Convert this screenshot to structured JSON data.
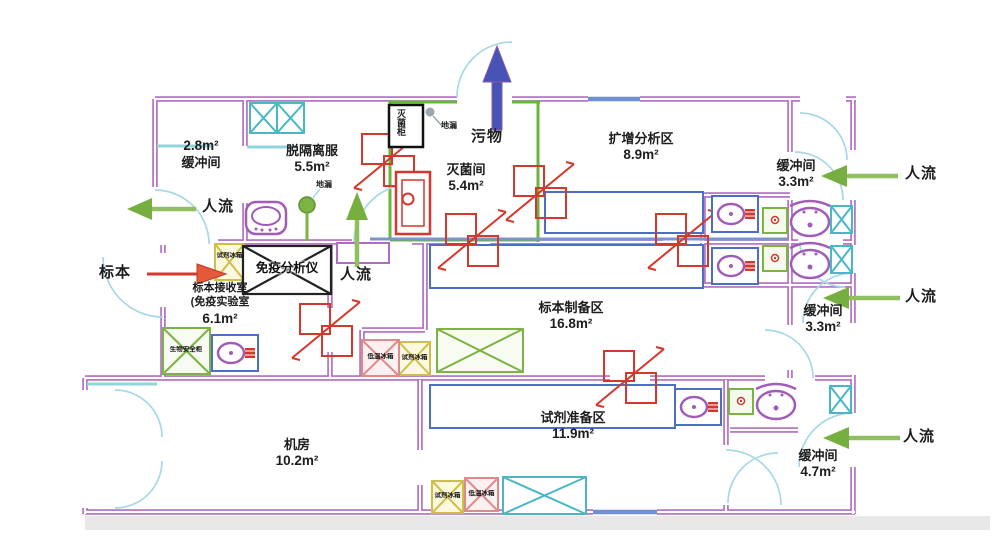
{
  "plan_title": "PCR实验室平面布局图",
  "rooms": [
    {
      "name": "缓冲间",
      "area": "2.8m²"
    },
    {
      "name": "脱隔离服",
      "area": "5.5m²"
    },
    {
      "name": "灭菌间",
      "area": "5.4m²"
    },
    {
      "name": "扩增分析区",
      "area": "8.9m²"
    },
    {
      "name": "缓冲间",
      "area": "3.3m²"
    },
    {
      "name": "缓冲间",
      "area": "3.3m²"
    },
    {
      "name": "标本接收室",
      "name2": "(免疫实验室",
      "area": "6.1m²"
    },
    {
      "name": "标本制备区",
      "area": "16.8m²"
    },
    {
      "name": "机房",
      "area": "10.2m²"
    },
    {
      "name": "试剂准备区",
      "area": "11.9m²"
    },
    {
      "name": "缓冲间",
      "area": "4.7m²"
    }
  ],
  "flows": {
    "people": [
      {
        "label": "人流",
        "direction": "left-out",
        "location": "top-left-buffer"
      },
      {
        "label": "人流",
        "direction": "up",
        "location": "center-corridor"
      },
      {
        "label": "人流",
        "direction": "left-in",
        "location": "top-right-buffer"
      },
      {
        "label": "人流",
        "direction": "left-in",
        "location": "mid-right-buffer"
      },
      {
        "label": "人流",
        "direction": "left-in",
        "location": "bottom-right-buffer"
      }
    ],
    "specimen": {
      "label": "标本",
      "direction": "right-in"
    },
    "waste": {
      "label": "污物",
      "direction": "up-out"
    }
  },
  "equipment": {
    "immuno_analyzer": {
      "label": "免疫分析仪"
    },
    "sterilizer": {
      "label": "灭菌柜"
    },
    "floor_drains": [
      {
        "label": "地漏"
      },
      {
        "label": "地漏"
      }
    ],
    "reagent_fridges": [
      {
        "label": "试剂冰箱"
      },
      {
        "label": "试剂冰箱"
      },
      {
        "label": "试剂冰箱"
      }
    ],
    "freezers": [
      {
        "label": "低温冰箱"
      },
      {
        "label": "低温冰箱"
      }
    ],
    "biosafety_cabinet": {
      "label": "生物安全柜"
    }
  },
  "colors": {
    "wall": "#b06cbf",
    "sterile_room_wall": "#6cb33f",
    "pass_through_red": "#d4372b",
    "flow_arrow_green": "#76ae3f",
    "waste_arrow_blue": "#4753b5",
    "specimen_arrow_red": "#d4372b",
    "door_arc": "#a8d8e6",
    "bench_blue": "#4a6fc4",
    "fixture_purple": "#a15cb8",
    "cabinet_cyan": "#49b8c4"
  }
}
